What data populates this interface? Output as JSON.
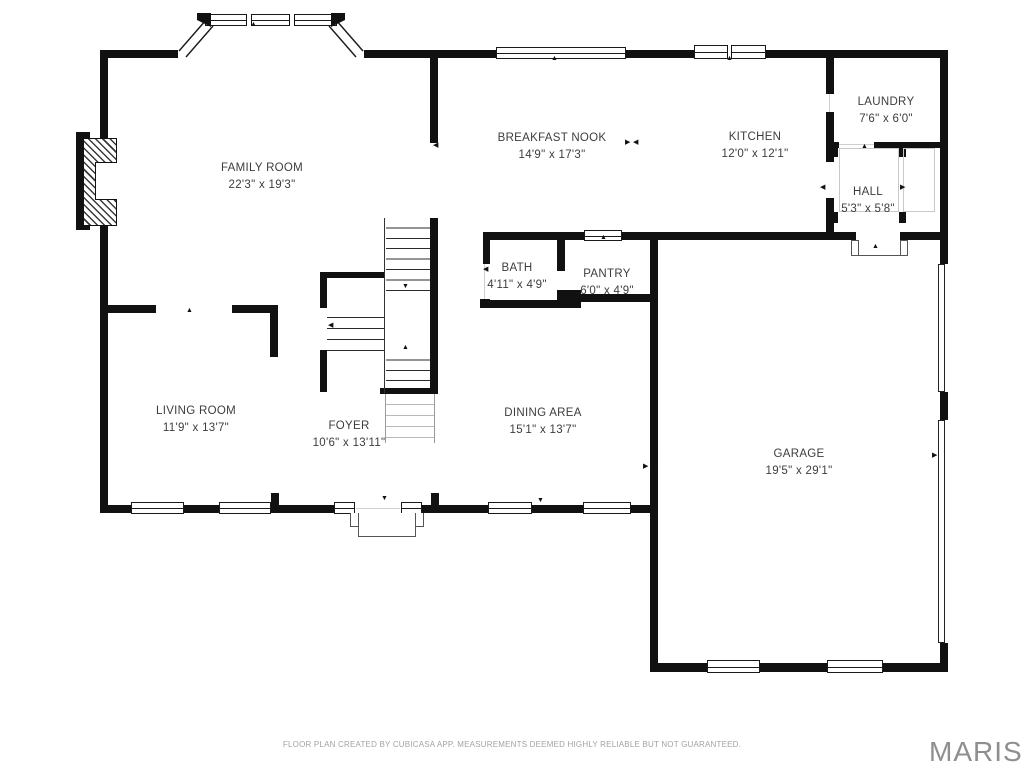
{
  "page": {
    "background": "#ffffff"
  },
  "colors": {
    "wall": "#111111",
    "window_line": "#1a1a1a",
    "light_line": "#c9c9c9",
    "label_text": "#3d3d3d",
    "footer_text": "#a3a3a3",
    "brand_text": "#8f8f8f"
  },
  "rooms": [
    {
      "id": "family-room",
      "name": "FAMILY ROOM",
      "dims": "22'3\" x 19'3\""
    },
    {
      "id": "breakfast-nook",
      "name": "BREAKFAST NOOK",
      "dims": "14'9\" x 17'3\""
    },
    {
      "id": "kitchen",
      "name": "KITCHEN",
      "dims": "12'0\" x 12'1\""
    },
    {
      "id": "laundry",
      "name": "LAUNDRY",
      "dims": "7'6\" x 6'0\""
    },
    {
      "id": "hall",
      "name": "HALL",
      "dims": "5'3\" x 5'8\""
    },
    {
      "id": "bath",
      "name": "BATH",
      "dims": "4'11\" x 4'9\""
    },
    {
      "id": "pantry",
      "name": "PANTRY",
      "dims": "6'0\" x 4'9\""
    },
    {
      "id": "living-room",
      "name": "LIVING ROOM",
      "dims": "11'9\" x 13'7\""
    },
    {
      "id": "foyer",
      "name": "FOYER",
      "dims": "10'6\" x 13'11\""
    },
    {
      "id": "dining-area",
      "name": "DINING AREA",
      "dims": "15'1\" x 13'7\""
    },
    {
      "id": "garage",
      "name": "GARAGE",
      "dims": "19'5\" x 29'1\""
    }
  ],
  "glyphs": {
    "up": "▲",
    "down": "▼",
    "left": "◀",
    "right": "▶"
  },
  "footer": {
    "disclaimer": "FLOOR PLAN CREATED BY CUBICASA APP. MEASUREMENTS DEEMED HIGHLY RELIABLE BUT NOT GUARANTEED.",
    "brand": "MARIS"
  }
}
